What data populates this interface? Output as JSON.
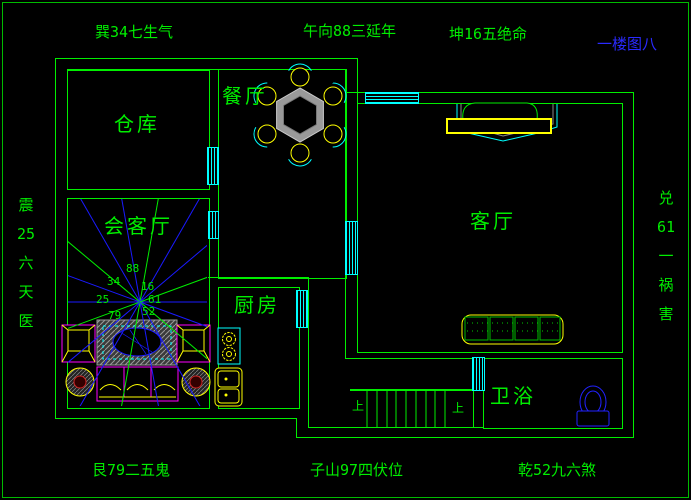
{
  "colors": {
    "background": "#000000",
    "wall_green": "#00ee00",
    "window_cyan": "#00ffff",
    "ray_blue": "#1a1aff",
    "furniture_magenta": "#ff00ff",
    "furniture_yellow": "#ffff00",
    "toilet_blue": "#2222ff",
    "title_blue": "#2a2aff"
  },
  "perimeter_labels": {
    "top_left": "巽34七生气",
    "top_center": "午向88三延年",
    "top_right": "坤16五绝命",
    "floor_title": "一楼图八",
    "left_lines": [
      "震",
      "25",
      "六",
      "天",
      "医"
    ],
    "right_lines": [
      "兑",
      "61",
      "一",
      "祸",
      "害"
    ],
    "bottom_left": "艮79二五鬼",
    "bottom_center": "子山97四伏位",
    "bottom_right": "乾52九六煞"
  },
  "rooms": {
    "warehouse": "仓库",
    "dining": "餐厅",
    "reception": "会客厅",
    "kitchen": "厨房",
    "living": "客厅",
    "bathroom": "卫浴"
  },
  "stairs": {
    "up_label_left": "上",
    "up_label_right": "上"
  },
  "fan_numbers": {
    "top": "88",
    "upper_left": "34",
    "upper_right": "16",
    "left": "25",
    "right": "61",
    "lower_left": "79",
    "lower_right": "52"
  }
}
